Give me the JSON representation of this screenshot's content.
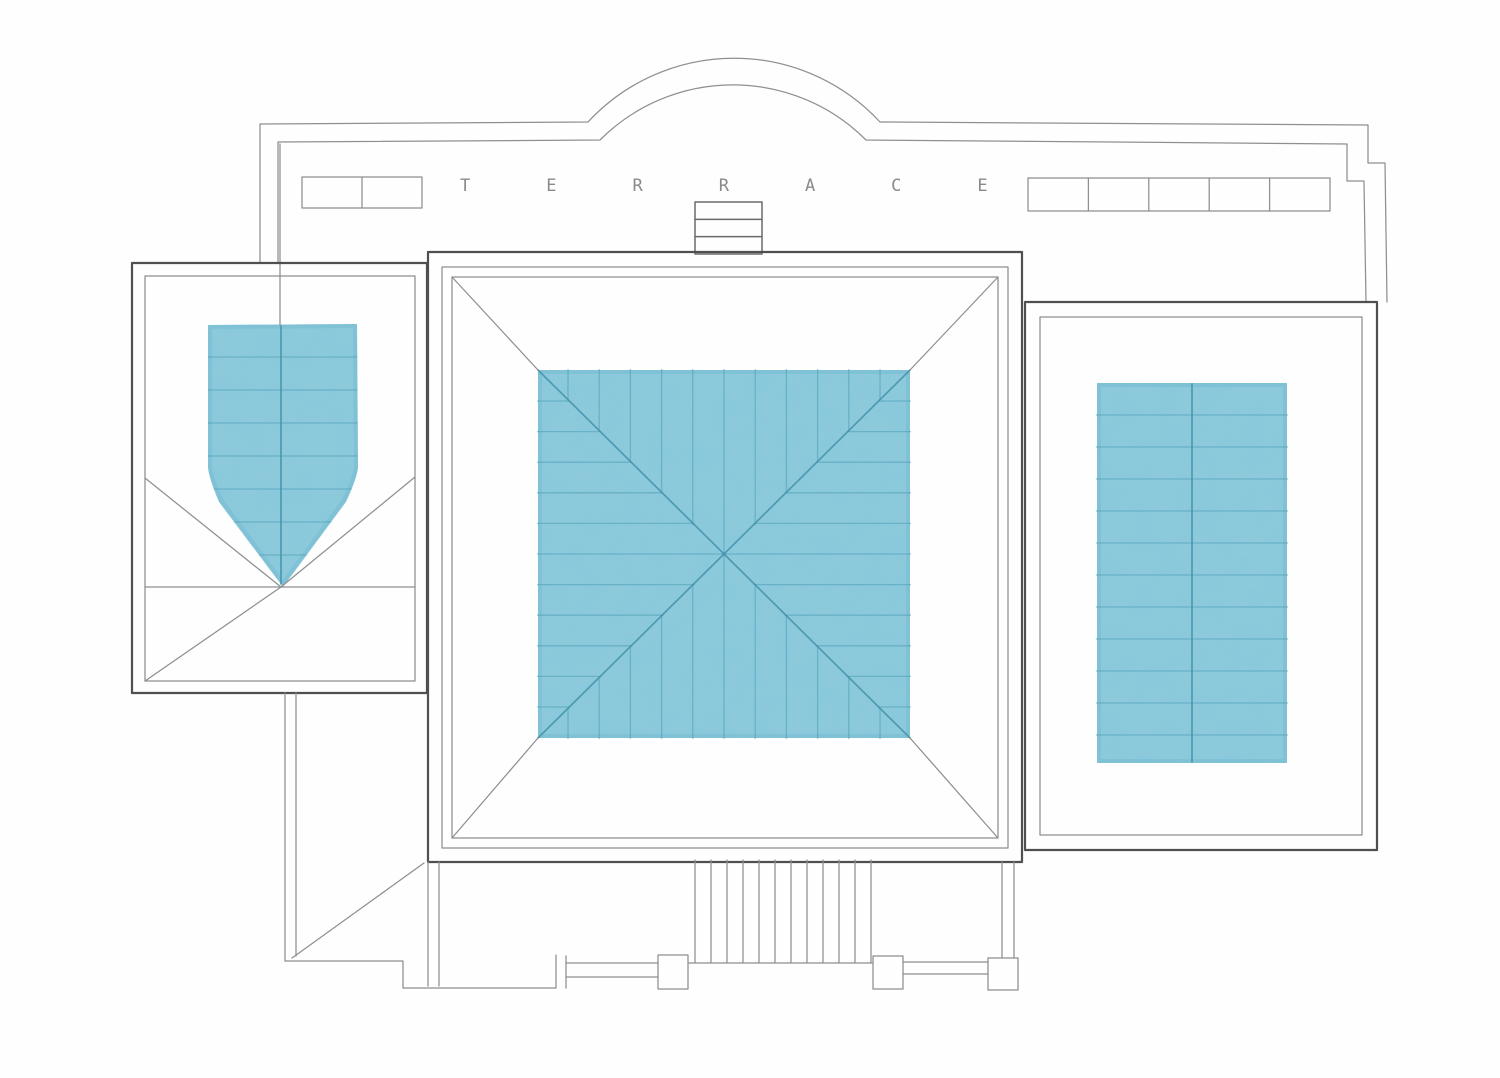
{
  "plan": {
    "terrace_label": "TERRACE"
  },
  "colors": {
    "paper": "#FEFEFE",
    "line_dark": "#4F4F4F",
    "line_light": "#8F8F8F",
    "text_gray": "#8A8A8A",
    "wash_blue": "#8AC9DB",
    "wash_blue_edge": "#6FB6CC",
    "hatch_teal": "#4E9DB5",
    "hatch_teal_strong": "#3F8EA8"
  },
  "features": {
    "skylight_strip_left": {
      "panels": 2
    },
    "skylight_strip_right": {
      "panels": 5
    },
    "chimney": {
      "bands": 3
    },
    "entrance_stairs": {
      "steps": 11
    },
    "balustrade": {
      "posts": 3
    }
  }
}
